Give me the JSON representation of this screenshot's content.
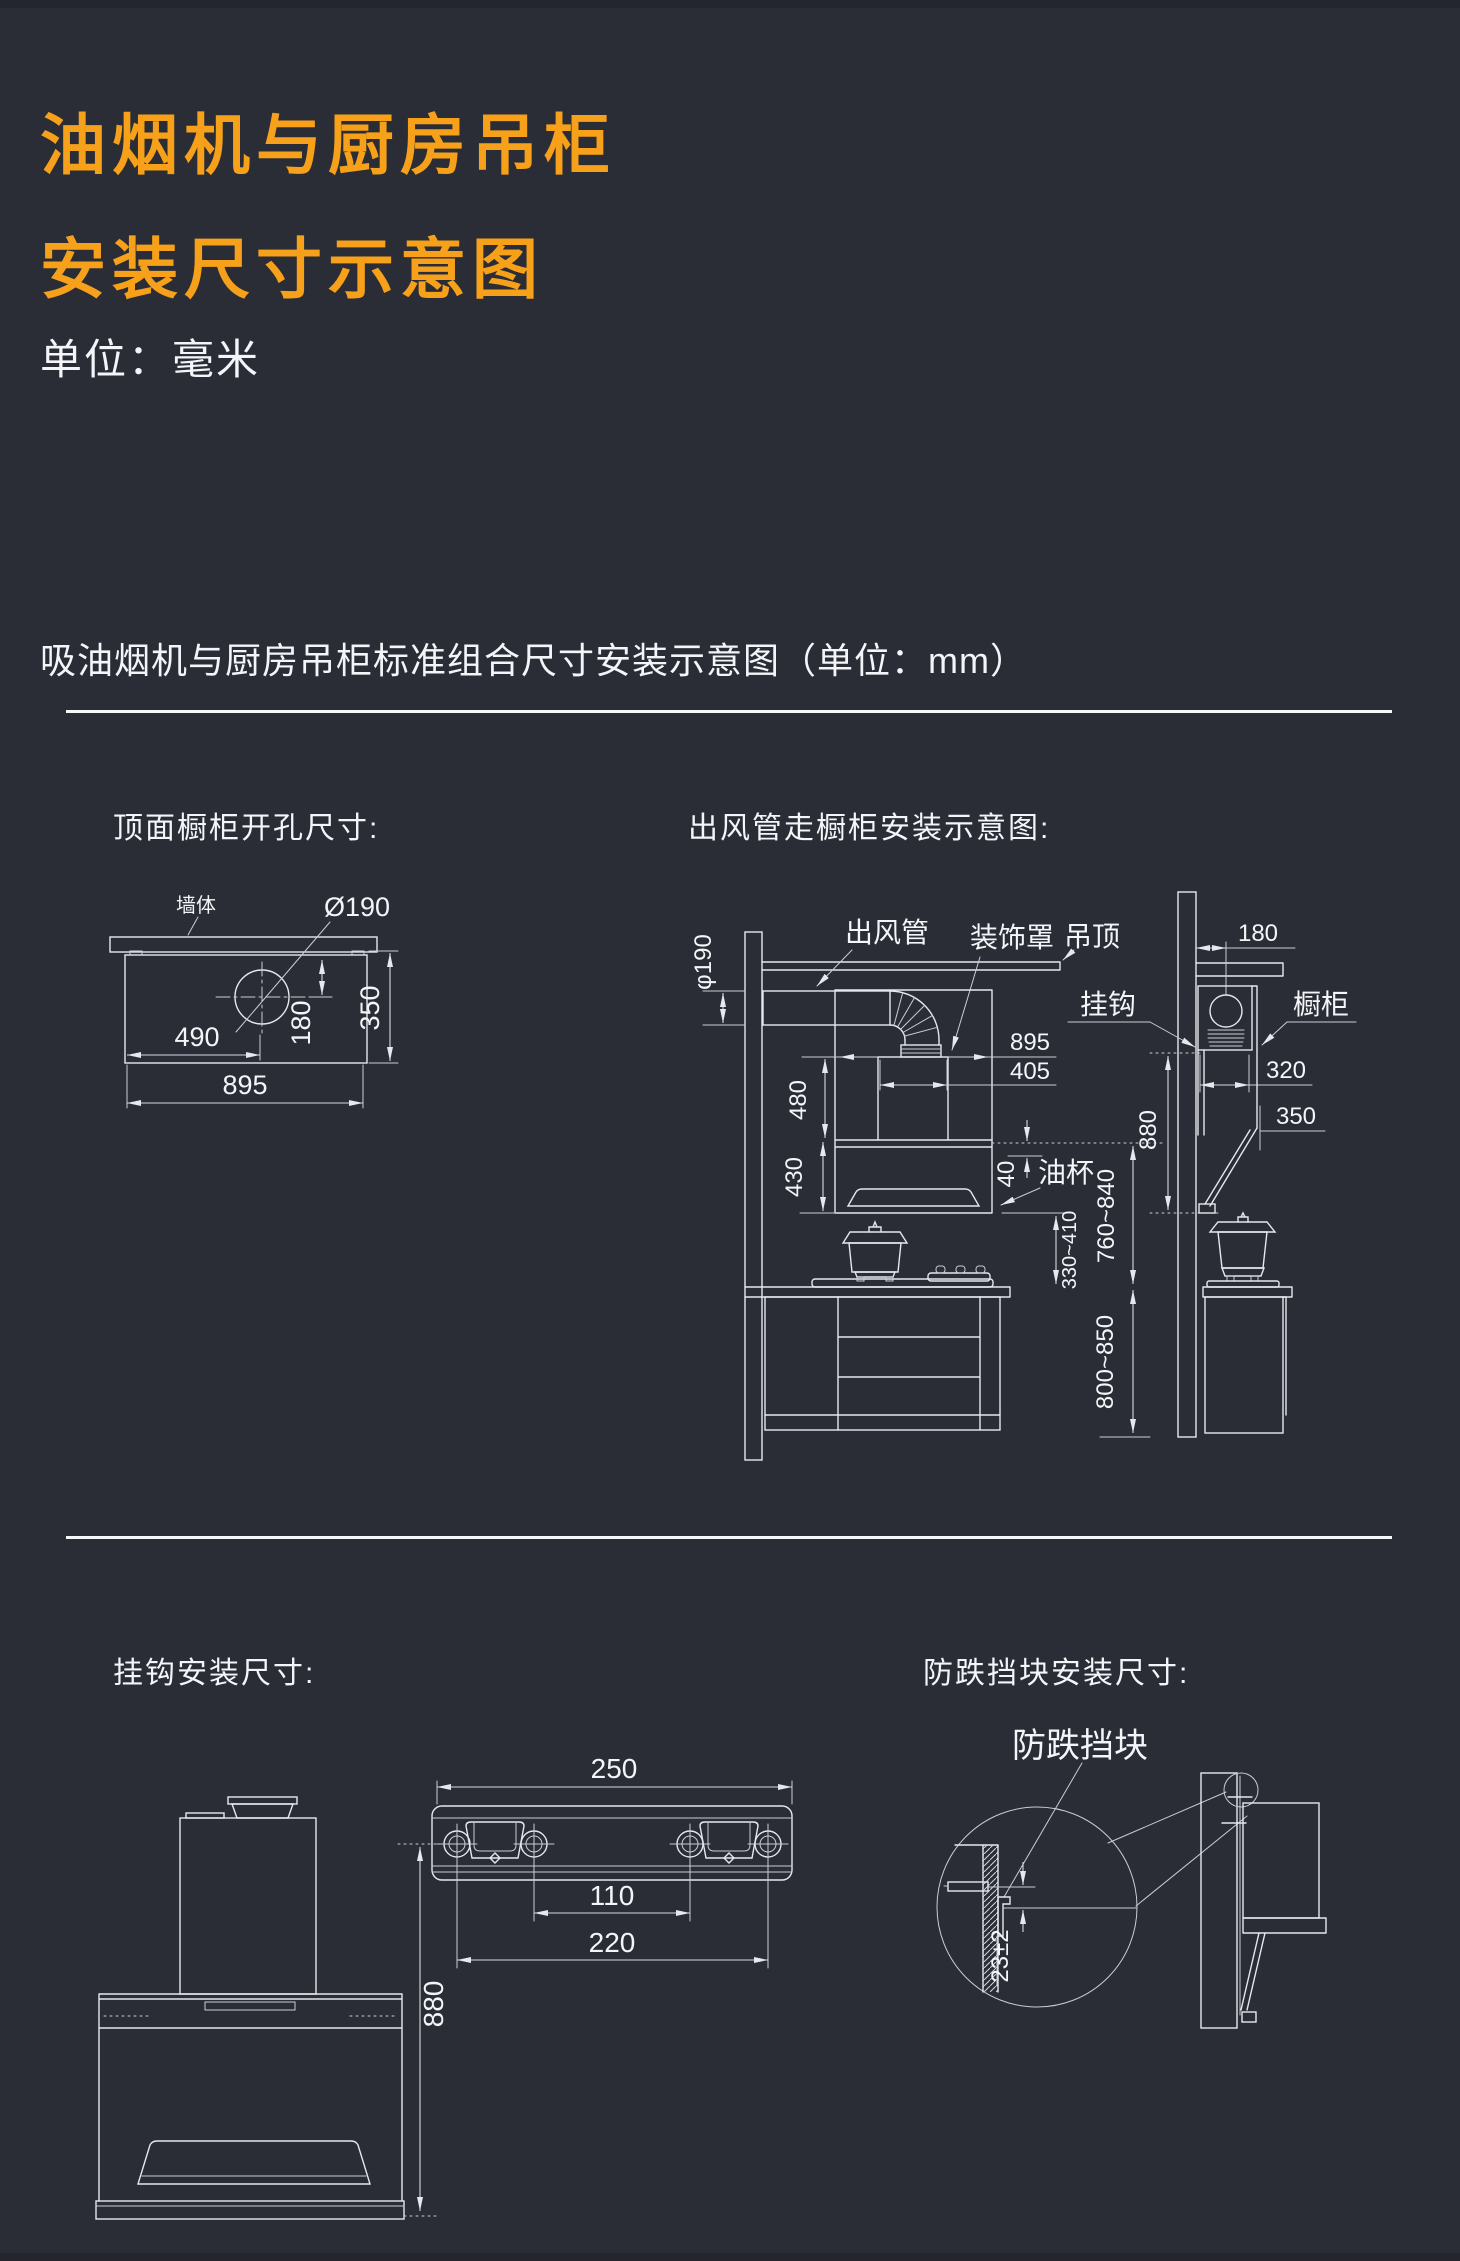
{
  "colors": {
    "background": "#2b2d36",
    "accent_orange": "#f7a11b",
    "line": "#e6e8ee",
    "text": "#f3f5f9"
  },
  "header": {
    "title_line1": "油烟机与厨房吊柜",
    "title_line2": "安装尺寸示意图",
    "unit_label": "单位：毫米",
    "subtitle": "吸油烟机与厨房吊柜标准组合尺寸安装示意图（单位：mm）"
  },
  "panels": {
    "top_opening": {
      "title": "顶面橱柜开孔尺寸:",
      "labels": {
        "wall": "墙体",
        "hole": "Ø190"
      },
      "dims": {
        "hole_offset_x": "490",
        "panel_width": "895",
        "hole_offset_y": "180",
        "panel_depth": "350"
      }
    },
    "duct_route": {
      "title": "出风管走橱柜安装示意图:",
      "labels": {
        "duct": "出风管",
        "cover": "装饰罩",
        "ceiling": "吊顶",
        "hook": "挂钩",
        "cabinet": "橱柜",
        "oil_cup": "油杯"
      },
      "dims": {
        "duct_dia": "φ190",
        "cover_height": "480",
        "body_height": "430",
        "hood_width": "895",
        "outlet_width": "405",
        "oil_cup_gap": "40",
        "bottom_to_counter": "330~410",
        "canopy_to_counter": "760~840",
        "counter_height": "800~850",
        "hook_to_bottom": "880",
        "wall_gap": "180",
        "cabinet_depth": "320",
        "counter_depth": "350"
      }
    },
    "hook": {
      "title": "挂钩安装尺寸:",
      "dims": {
        "plate_width": "250",
        "hole_span_inner": "110",
        "hole_span_outer": "220",
        "hook_to_bottom": "880"
      }
    },
    "block": {
      "title": "防跌挡块安装尺寸:",
      "labels": {
        "block": "防跌挡块"
      },
      "dims": {
        "block_offset": "23±2"
      }
    }
  }
}
